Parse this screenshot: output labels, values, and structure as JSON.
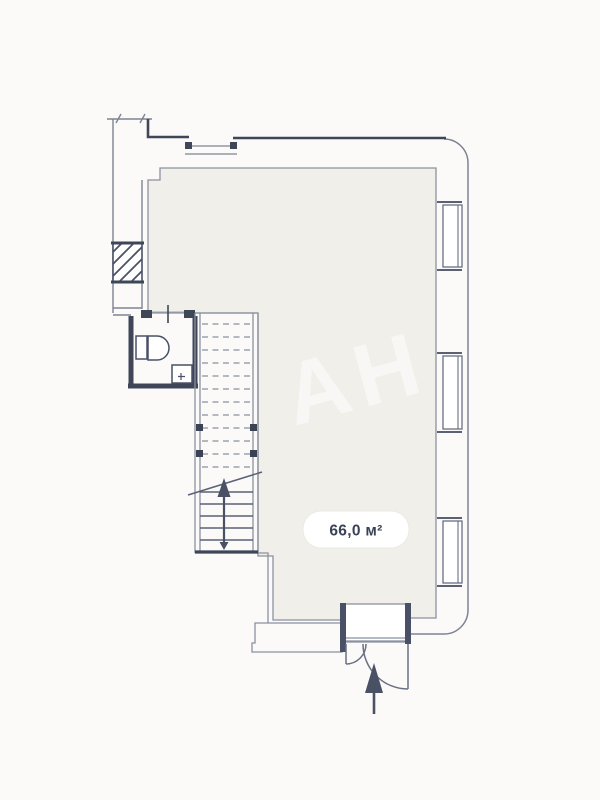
{
  "floorplan": {
    "area_label": "66,0 м²",
    "watermark": "АН",
    "features": {
      "entrance": "double entrance door with inward arrow",
      "staircase": "two-flight staircase with up-direction arrow",
      "wc": "toilet and sink",
      "right_wall_windows": 3,
      "top_wall_windows": 1,
      "hatched_wall_segments": 1
    },
    "colors": {
      "page_bg": "#fbfaf9",
      "floor_fill": "#f1efe9",
      "wall_light": "#8b91a0",
      "wall_dark": "#3f4658",
      "label_text": "#3a4257",
      "badge_bg": "#ffffff"
    }
  }
}
